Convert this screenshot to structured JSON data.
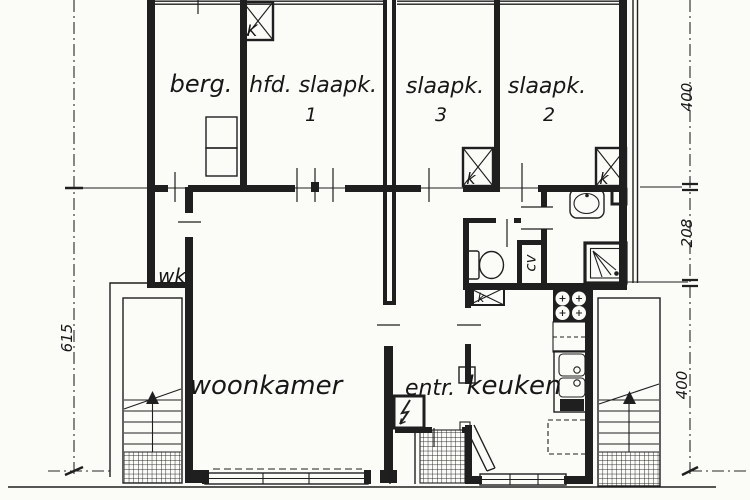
{
  "colors": {
    "paper": "#fbfbf8",
    "ink": "#1f1f1f"
  },
  "rooms": {
    "berg": {
      "label": "berg."
    },
    "hoofdslaapkamer": {
      "label": "hfd. slaapk.",
      "number": "1"
    },
    "slaapkamer3": {
      "label": "slaapk.",
      "number": "3"
    },
    "slaapkamer2": {
      "label": "slaapk.",
      "number": "2"
    },
    "woonkamer": {
      "label": "woonkamer"
    },
    "entree": {
      "label": "entr."
    },
    "keuken": {
      "label": "keuken"
    },
    "werkkast": {
      "label": "wk"
    },
    "cv_kast": {
      "label": "cv"
    }
  },
  "flues": {
    "hoofdslaapkamer": "K",
    "slaapkamer3": "k",
    "slaapkamer2": "k",
    "keuken": "k"
  },
  "dimensions": {
    "right_top": "400",
    "right_middle": "208",
    "right_bottom": "400",
    "left": "615"
  }
}
